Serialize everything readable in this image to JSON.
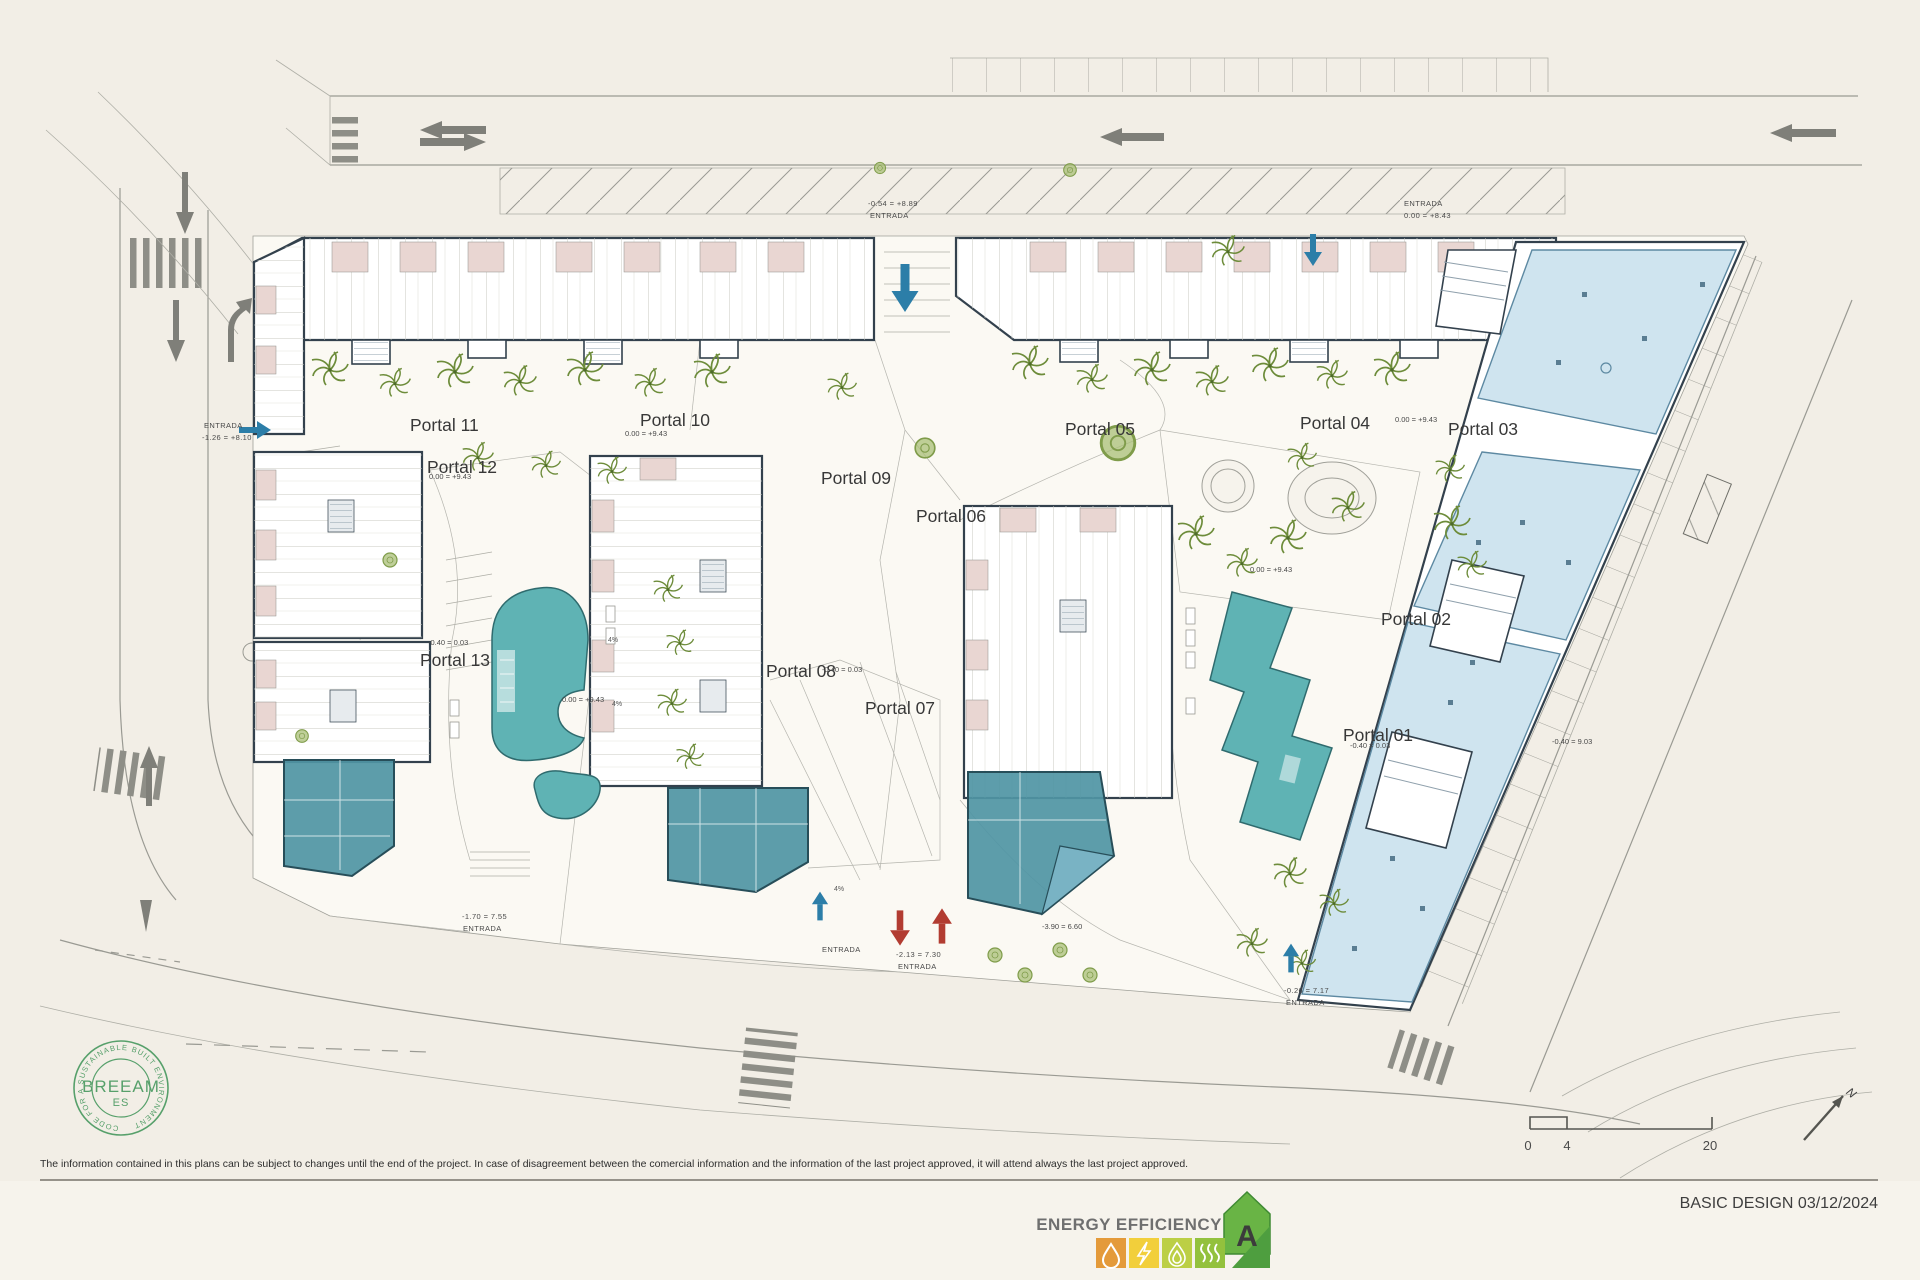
{
  "plan": {
    "portals": [
      {
        "label": "Portal 01"
      },
      {
        "label": "Portal 02"
      },
      {
        "label": "Portal 03"
      },
      {
        "label": "Portal 04"
      },
      {
        "label": "Portal 05"
      },
      {
        "label": "Portal 06"
      },
      {
        "label": "Portal 07"
      },
      {
        "label": "Portal 08"
      },
      {
        "label": "Portal 09"
      },
      {
        "label": "Portal 10"
      },
      {
        "label": "Portal 11"
      },
      {
        "label": "Portal 12"
      },
      {
        "label": "Portal 13"
      }
    ],
    "elevations": [
      "0.00 = +9.43",
      "0.00 = +9.43",
      "0.00 = +9.43",
      "0.00 = +9.43",
      "0.00 = +9.43",
      "-0.40 = 0.03",
      "-0.40 = 0.03",
      "-0.40 = 0.03",
      "-0.40 = 9.03",
      "-3.90 = 6.60"
    ],
    "entrances": [
      {
        "line1": "-0.54 = +8.89",
        "line2": "ENTRADA"
      },
      {
        "line1": "ENTRADA",
        "line2": "0.00 = +8.43"
      },
      {
        "line1": "ENTRADA",
        "line2": "-1.26 = +8.10"
      },
      {
        "line1": "-1.70 = 7.55",
        "line2": "ENTRADA"
      },
      {
        "line1": "ENTRADA",
        "line2": ""
      },
      {
        "line1": "-2.13 = 7.30",
        "line2": "ENTRADA"
      },
      {
        "line1": "-0.26 = 7.17",
        "line2": "ENTRADA"
      }
    ],
    "slopes": [
      "4%",
      "4%",
      "4%"
    ]
  },
  "scale_bar": {
    "t0": "0",
    "t1": "4",
    "t2": "20"
  },
  "north": {
    "label": "N"
  },
  "breeam": {
    "ring": "CODE FOR A SUSTAINABLE BUILT ENVIRONMENT",
    "name": "BREEAM",
    "region": "ES"
  },
  "footer": {
    "disclaimer": "The information contained in this plans can be subject to changes until the end of the project. In case of disagreement between the comercial information and the information of the last project approved, it will attend always the last project approved.",
    "stamp": "BASIC DESIGN 03/12/2024"
  },
  "energy": {
    "label": "ENERGY EFFICIENCY",
    "rating": "A"
  }
}
